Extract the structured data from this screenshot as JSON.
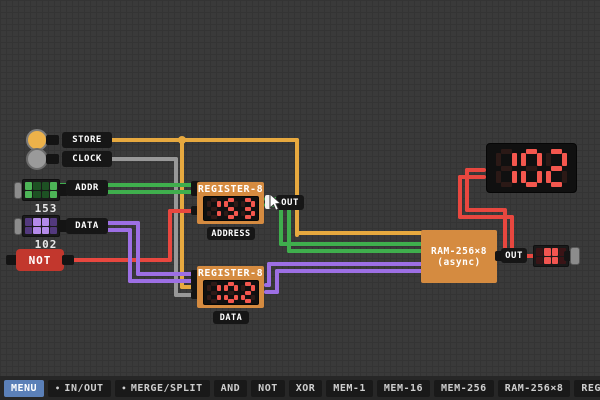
{
  "inputs": {
    "store": {
      "label": "STORE"
    },
    "clock": {
      "label": "CLOCK"
    },
    "addr": {
      "label": "ADDR",
      "value": "153",
      "bits": [
        1,
        0,
        0,
        1,
        1,
        0,
        0,
        1
      ]
    },
    "data": {
      "label": "DATA",
      "value": "102",
      "bits": [
        0,
        1,
        1,
        0,
        0,
        1,
        1,
        0
      ]
    },
    "not_gate": {
      "label": "NOT"
    }
  },
  "registers": {
    "address": {
      "title": "REGISTER-8",
      "display": "153",
      "caption": "ADDRESS",
      "out_label": "OUT"
    },
    "data": {
      "title": "REGISTER-8",
      "display": "102",
      "caption": "DATA"
    }
  },
  "ram": {
    "title_line1": "RAM-256×8",
    "title_line2": "(async)",
    "out_label": "OUT",
    "out_value_bits": [
      0,
      1,
      1,
      0,
      0,
      1,
      1,
      0
    ]
  },
  "big_display": {
    "value": "102"
  },
  "toolbar": {
    "items": [
      {
        "label": "MENU",
        "active": true
      },
      {
        "label": "IN/OUT",
        "bullet": true
      },
      {
        "label": "MERGE/SPLIT",
        "bullet": true
      },
      {
        "label": "AND"
      },
      {
        "label": "NOT"
      },
      {
        "label": "XOR"
      },
      {
        "label": "MEM-1"
      },
      {
        "label": "MEM-16"
      },
      {
        "label": "MEM-256"
      },
      {
        "label": "RAM-256×8"
      },
      {
        "label": "REGISTER-8"
      },
      {
        "label": "DECIMAL-8"
      },
      {
        "label": "EQUA"
      }
    ]
  },
  "colors": {
    "wire_store": "#e7a93f",
    "wire_clock": "#989898",
    "wire_addr": "#3fae4d",
    "wire_data": "#9d6fe4",
    "wire_out": "#e8473f",
    "chip_orange": "#d58b40",
    "segment_lit": "#f4574e",
    "segment_off": "#2e1a17",
    "menu_active": "#5b80b8"
  }
}
